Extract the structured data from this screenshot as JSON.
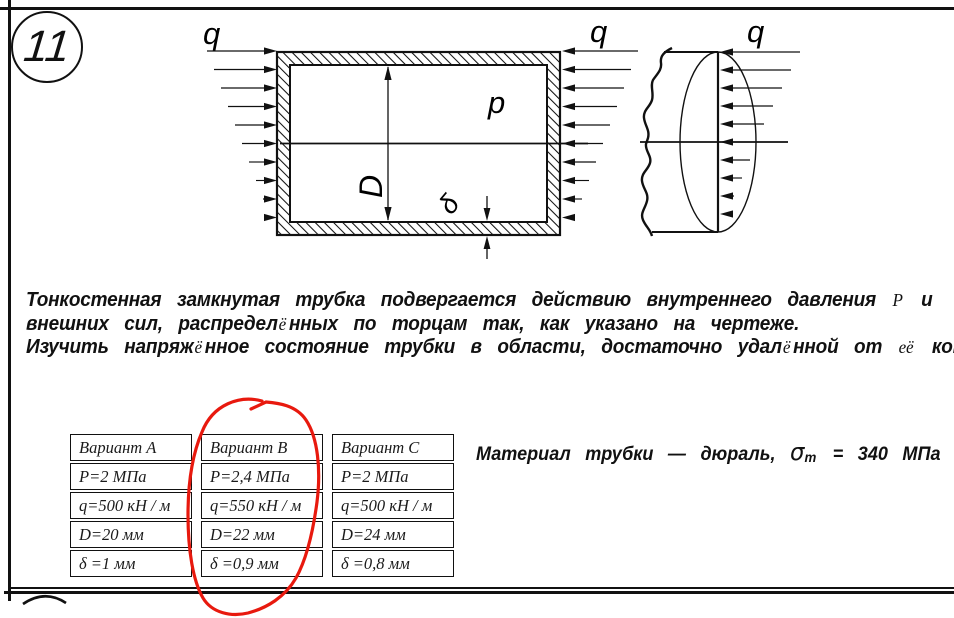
{
  "problem": {
    "number": "11",
    "lines": [
      [
        {
          "t": "Тонкостенная замкнутая трубка подвергается действию внутреннего давления "
        },
        {
          "t": "P",
          "cls": "serif"
        },
        {
          "t": " и"
        }
      ],
      [
        {
          "t": "внешних сил, распредел"
        },
        {
          "t": "ё",
          "cls": "serif"
        },
        {
          "t": "нных по торцам так, как указано на чертеже."
        }
      ],
      [
        {
          "t": "Изучить напряж"
        },
        {
          "t": "ё",
          "cls": "serif"
        },
        {
          "t": "нное состояние трубки в области, достаточно удал"
        },
        {
          "t": "ё",
          "cls": "serif"
        },
        {
          "t": "нной от "
        },
        {
          "t": "её",
          "cls": "serif"
        },
        {
          "t": " концов."
        }
      ]
    ]
  },
  "figure": {
    "labels": {
      "q_left": "q",
      "q_right": "q",
      "q_end": "q",
      "pressure": "p",
      "diameter": "D",
      "thickness": "δ"
    }
  },
  "table": {
    "columns": [
      {
        "header": "Вариант A",
        "rows": [
          "P=2 МПа",
          "q=500 кН / м",
          "D=20 мм",
          "δ =1 мм"
        ]
      },
      {
        "header": "Вариант B",
        "rows": [
          "P=2,4 МПа",
          "q=550 кН / м",
          "D=22 мм",
          "δ =0,9 мм"
        ]
      },
      {
        "header": "Вариант C",
        "rows": [
          "P=2 МПа",
          "q=500 кН / м",
          "D=24 мм",
          "δ =0,8 мм"
        ]
      }
    ],
    "selected_column": "Вариант B"
  },
  "material": {
    "prefix": "Материал трубки — дюраль, ",
    "sigma": "σ",
    "sigma_sub": "т",
    "suffix": " = 340 МПа"
  },
  "colors": {
    "ink": "#111111",
    "highlight": "#e8190e"
  }
}
